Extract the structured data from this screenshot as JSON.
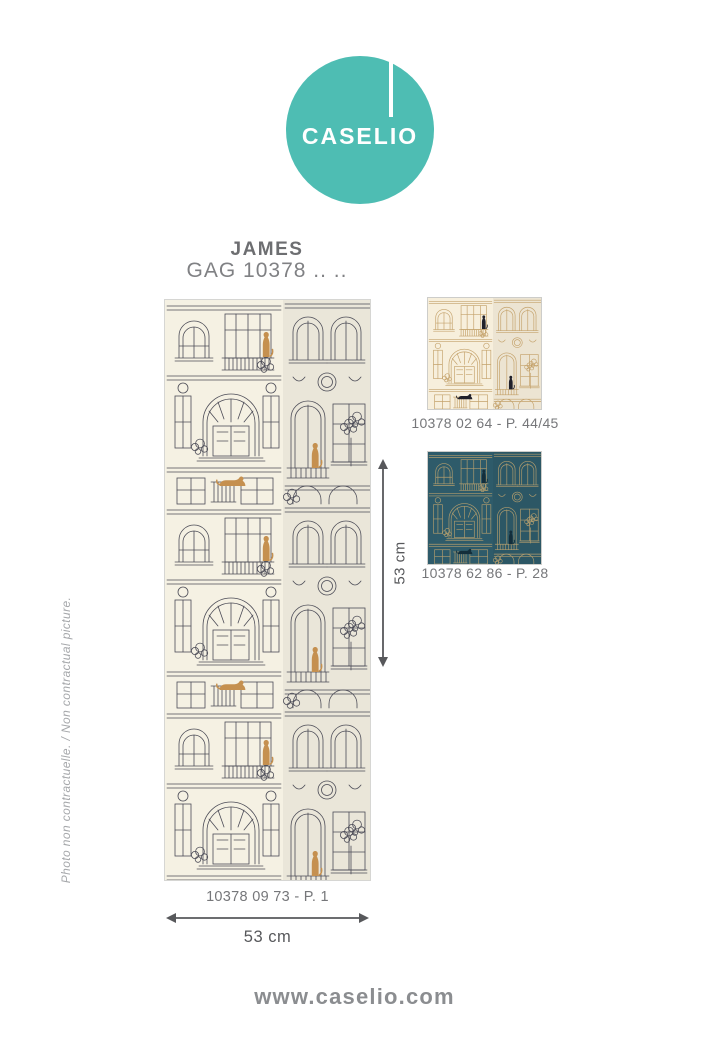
{
  "brand": {
    "logo_text": "CASELIO",
    "logo_color": "#4ebdb3",
    "website": "www.caselio.com"
  },
  "product": {
    "name": "JAMES",
    "reference": "GAG 10378 .. .."
  },
  "main_panel": {
    "caption": "10378 09 73 - P. 1",
    "width_label": "53 cm",
    "height_label": "53 cm",
    "colors": {
      "bg": "#f5f1e3",
      "line": "#4c4c57",
      "cat": "#c5904f"
    }
  },
  "swatches": [
    {
      "caption": "10378 02 64 - P. 44/45",
      "colors": {
        "bg": "#f7efdc",
        "line": "#c4a26b",
        "cat": "#20202a"
      }
    },
    {
      "caption": "10378 62 86 - P. 28",
      "colors": {
        "bg": "#2e5b6a",
        "line": "#b19d6e",
        "cat": "#132e3b"
      }
    }
  ],
  "disclaimer": "Photo non contractuelle. / Non contractual picture.",
  "dimension_color": "#57585b"
}
